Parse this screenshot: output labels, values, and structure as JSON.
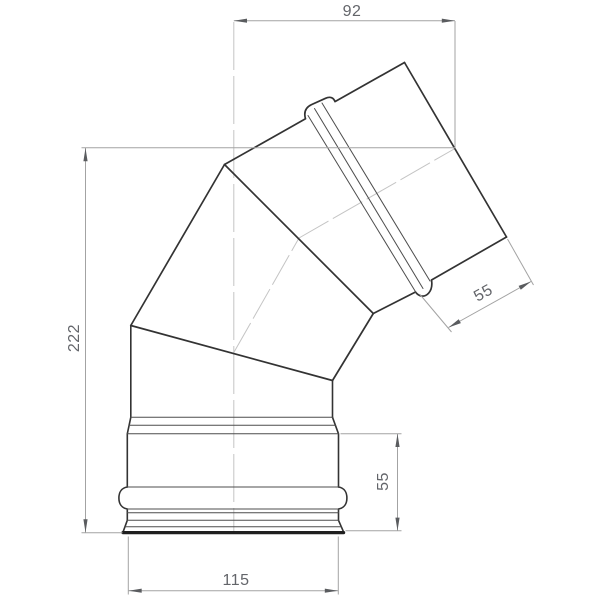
{
  "dims": {
    "top_width": "92",
    "overall_height": "222",
    "upper_socket_depth": "55",
    "lower_socket_depth": "55",
    "base_width": "115"
  },
  "colors": {
    "outline": "#333333",
    "thin_line": "#4d4d4d",
    "heavy_line": "#1f1f1f",
    "dim_line": "#a3a3a3",
    "arrow": "#5a5c5f",
    "dim_text": "#63656a",
    "centerline": "#c4c4c4",
    "background": "#ffffff"
  }
}
